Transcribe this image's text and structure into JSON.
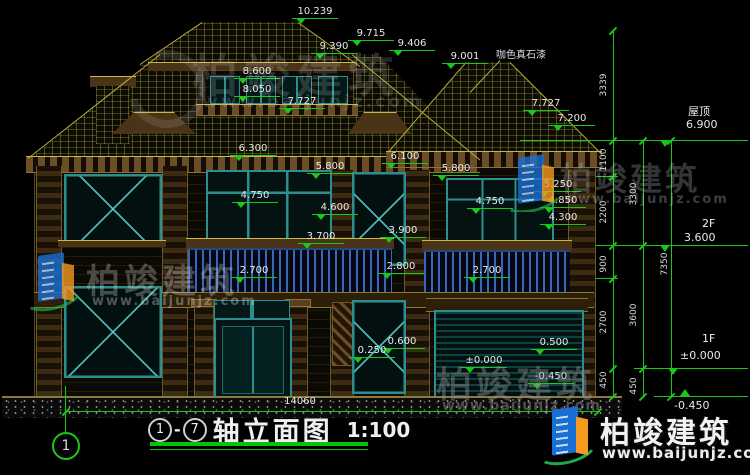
{
  "watermark": {
    "brand": "柏竣建筑",
    "url": "www.baijunjz.com"
  },
  "material_note": "咖色真石漆",
  "bottom_dimension": "14060",
  "axis_bubble": "1",
  "title": {
    "axis_start": "1",
    "dash": "-",
    "axis_end": "7",
    "name": "轴立面图",
    "scale": "1:100"
  },
  "right_levels": {
    "roof": {
      "name": "屋顶",
      "value": "6.900"
    },
    "f2": {
      "name": "2F",
      "value": "3.600"
    },
    "f1": {
      "name": "1F",
      "value": "±0.000"
    },
    "below_grade": {
      "value": "-0.450"
    }
  },
  "elevation_labels": [
    {
      "t": "10.239",
      "x": 292,
      "y": 6
    },
    {
      "t": "9.715",
      "x": 348,
      "y": 28
    },
    {
      "t": "9.390",
      "x": 311,
      "y": 41
    },
    {
      "t": "9.406",
      "x": 389,
      "y": 38
    },
    {
      "t": "9.001",
      "x": 442,
      "y": 51
    },
    {
      "t": "8.600",
      "x": 234,
      "y": 66
    },
    {
      "t": "8.050",
      "x": 234,
      "y": 84
    },
    {
      "t": "7.727",
      "x": 279,
      "y": 96
    },
    {
      "t": "7.727",
      "x": 523,
      "y": 98
    },
    {
      "t": "7.200",
      "x": 549,
      "y": 113
    },
    {
      "t": "6.300",
      "x": 230,
      "y": 143
    },
    {
      "t": "6.100",
      "x": 382,
      "y": 151
    },
    {
      "t": "5.800",
      "x": 307,
      "y": 161
    },
    {
      "t": "5.800",
      "x": 433,
      "y": 163
    },
    {
      "t": "5.250",
      "x": 535,
      "y": 179
    },
    {
      "t": "4.850",
      "x": 540,
      "y": 195
    },
    {
      "t": "4.750",
      "x": 232,
      "y": 190
    },
    {
      "t": "4.750",
      "x": 467,
      "y": 196
    },
    {
      "t": "4.600",
      "x": 312,
      "y": 202
    },
    {
      "t": "4.300",
      "x": 540,
      "y": 212
    },
    {
      "t": "3.900",
      "x": 380,
      "y": 225
    },
    {
      "t": "3.700",
      "x": 298,
      "y": 231
    },
    {
      "t": "2.800",
      "x": 378,
      "y": 261
    },
    {
      "t": "2.700",
      "x": 231,
      "y": 265
    },
    {
      "t": "2.700",
      "x": 464,
      "y": 265
    },
    {
      "t": "0.600",
      "x": 379,
      "y": 336
    },
    {
      "t": "0.250",
      "x": 349,
      "y": 345
    },
    {
      "t": "0.500",
      "x": 531,
      "y": 337
    },
    {
      "t": "±0.000",
      "x": 461,
      "y": 355
    },
    {
      "t": "-0.450",
      "x": 528,
      "y": 371
    }
  ],
  "chain_dimensions": [
    {
      "t": "3339",
      "cx": 605,
      "cy": 85
    },
    {
      "t": "1100",
      "cx": 605,
      "cy": 160
    },
    {
      "t": "2200",
      "cx": 605,
      "cy": 212
    },
    {
      "t": "900",
      "cx": 605,
      "cy": 264
    },
    {
      "t": "2700",
      "cx": 605,
      "cy": 322
    },
    {
      "t": "450",
      "cx": 605,
      "cy": 380
    },
    {
      "t": "3300",
      "cx": 635,
      "cy": 194
    },
    {
      "t": "3600",
      "cx": 635,
      "cy": 315
    },
    {
      "t": "450",
      "cx": 635,
      "cy": 386
    },
    {
      "t": "7350",
      "cx": 666,
      "cy": 264
    }
  ],
  "colors": {
    "dimension_green": "#19c819",
    "construction_yellow": "#b8ac3c",
    "frame_teal": "#2b8f8f",
    "railing_blue": "#3a66b8"
  }
}
